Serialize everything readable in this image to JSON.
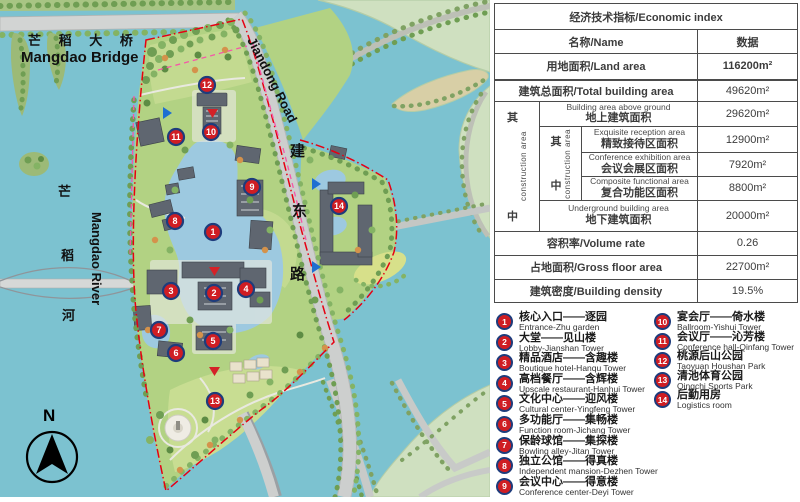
{
  "map": {
    "labels": {
      "bridge_zh": "芒 稻 大 桥",
      "bridge_en": "Mangdao Bridge",
      "river_zh_chars": [
        "芒",
        "稻",
        "河"
      ],
      "river_en": "Mangdao River",
      "road_en": "Jiandong Road",
      "road_zh_chars": [
        "建",
        "东",
        "路"
      ],
      "compass_n": "N"
    },
    "markers": [
      {
        "n": "1"
      },
      {
        "n": "2"
      },
      {
        "n": "3"
      },
      {
        "n": "4"
      },
      {
        "n": "5"
      },
      {
        "n": "6"
      },
      {
        "n": "7"
      },
      {
        "n": "8"
      },
      {
        "n": "9"
      },
      {
        "n": "10"
      },
      {
        "n": "11"
      },
      {
        "n": "12"
      },
      {
        "n": "13"
      },
      {
        "n": "14"
      }
    ]
  },
  "colors": {
    "water": "#7cc2d0",
    "site_green": "#b2d283",
    "pale_land": "#cfe0c0",
    "marker_red": "#cf1d23",
    "marker_ring": "#1e3c7c",
    "boundary_red": "#e60012",
    "axis_pink": "#f557a8"
  },
  "table": {
    "title": "经济技术指标/Economic index",
    "header": {
      "name": "名称/Name",
      "data": "数据"
    },
    "land_area": {
      "label": "用地面积/Land area",
      "value": "116200m²"
    },
    "total_building": {
      "label": "建筑总面积/Total building area",
      "value": "49620m²"
    },
    "among_outer": {
      "zh1": "其",
      "zh2": "中",
      "en": "construction area"
    },
    "among_inner": {
      "zh1": "其",
      "zh2": "中",
      "en": "construction area"
    },
    "above_ground": {
      "en": "Building area above ground",
      "zh": "地上建筑面积",
      "value": "29620m²"
    },
    "reception": {
      "en": "Exquisite reception area",
      "zh": "精致接待区面积",
      "value": "12900m²"
    },
    "exhibition": {
      "en": "Conference exhibition area",
      "zh": "会议会展区面积",
      "value": "7920m²"
    },
    "composite": {
      "en": "Composite functional area",
      "zh": "复合功能区面积",
      "value": "8800m²"
    },
    "underground": {
      "en": "Underground building area",
      "zh": "地下建筑面积",
      "value": "20000m²"
    },
    "volume_rate": {
      "label": "容积率/Volume rate",
      "value": "0.26"
    },
    "gross_floor": {
      "label": "占地面积/Gross floor area",
      "value": "22700m²"
    },
    "density": {
      "label": "建筑密度/Building density",
      "value": "19.5%"
    }
  },
  "legend": {
    "items": [
      {
        "num": "1",
        "zh": "核心入口——逐园",
        "en": "Entrance-Zhu garden"
      },
      {
        "num": "2",
        "zh": "大堂——见山楼",
        "en": "Lobby-Jianshan Tower"
      },
      {
        "num": "3",
        "zh": "精品酒店——含趣楼",
        "en": "Boutique hotel-Hanqu Tower"
      },
      {
        "num": "4",
        "zh": "高档餐厅——含辉楼",
        "en": "Upscale restaurant-Hanhui Tower"
      },
      {
        "num": "5",
        "zh": "文化中心——迎风楼",
        "en": "Cultural center-Yingfeng Tower"
      },
      {
        "num": "6",
        "zh": "多功能厅——集畅楼",
        "en": "Function room-Jichang Tower"
      },
      {
        "num": "7",
        "zh": "保龄球馆——集探楼",
        "en": "Bowling alley-Jitan Tower"
      },
      {
        "num": "8",
        "zh": "独立公馆——得真楼",
        "en": "Independent mansion-Dezhen Tower"
      },
      {
        "num": "9",
        "zh": "会议中心——得意楼",
        "en": "Conference center-Deyi Tower"
      },
      {
        "num": "10",
        "zh": "宴会厅——倚水楼",
        "en": "Ballroom-Yishui Tower"
      },
      {
        "num": "11",
        "zh": "会议厅——沁芳楼",
        "en": "Conference hall-Qinfang Tower"
      },
      {
        "num": "12",
        "zh": "桃源后山公园",
        "en": "Taoyuan Houshan Park"
      },
      {
        "num": "13",
        "zh": "清池体育公园",
        "en": "Qingchi Sports Park"
      },
      {
        "num": "14",
        "zh": "后勤用房",
        "en": "Logistics room"
      }
    ]
  }
}
